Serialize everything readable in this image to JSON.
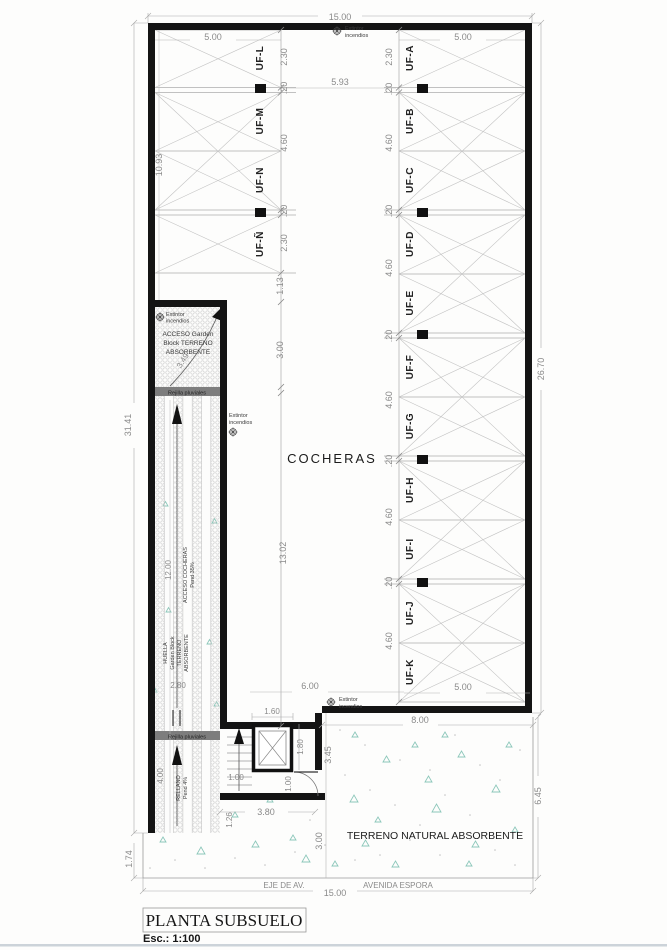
{
  "title_block": {
    "title": "PLANTA SUBSUELO",
    "scale": "Esc.: 1:100"
  },
  "labels": {
    "cocheras": "COCHERAS",
    "terreno": "TERRENO NATURAL ABSORBENTE",
    "eje": "EJE  DE  AV.",
    "avenida": "AVENIDA  ESPORA",
    "rejilla": "Rejilla pluviales",
    "extintor": [
      "Extintor",
      "incendios"
    ],
    "acceso_box": [
      "ACCESO Garden",
      "Block TERRENO",
      "ABSORBENTE"
    ],
    "huella": [
      "HUELLA",
      "Garden Block",
      "TERRENO",
      "ABSORBENTE"
    ],
    "acceso_rampa": [
      "ACCESO COCHERAS",
      "Pend 35%"
    ],
    "rellano": [
      "RELLANO",
      "Pend 4%"
    ]
  },
  "parking": {
    "left": [
      "UF-L",
      "UF-M",
      "UF-N",
      "UF-Ñ"
    ],
    "right": [
      "UF-A",
      "UF-B",
      "UF-C",
      "UF-D",
      "UF-E",
      "UF-F",
      "UF-G",
      "UF-H",
      "UF-I",
      "UF-J",
      "UF-K"
    ]
  },
  "dims": {
    "top_total": "15.00",
    "bottom_total": "15.00",
    "left_total": "31.41",
    "left_bottom": "1.74",
    "left_col": "10.93",
    "right_total": "26.70",
    "right_bottom": "6.45",
    "stall_top_left": "5.00",
    "stall_top_right": "5.00",
    "stall_bottom": "5.00",
    "aisle": "5.93",
    "six": "6.00",
    "eight": "8.00",
    "curve": "3.49",
    "ramp_len": "12.00",
    "ramp_w": "2.80",
    "rellano_len": "4.00",
    "elev_w": "1.60",
    "elev_d": "1.80",
    "stair_w": "1.00",
    "door_w": "1.00",
    "vest_w": "3.80",
    "vest_b": "1.26",
    "patio": "3.45",
    "terr": "3.00",
    "chain_left": [
      "2.30",
      ".20",
      "4.60",
      ".20",
      "2.30",
      "1.13",
      "3.00",
      "13.02"
    ],
    "chain_right": [
      "2.30",
      ".20",
      "4.60",
      ".20",
      "4.60",
      ".20",
      "4.60",
      ".20",
      "4.60",
      ".20",
      "4.60"
    ]
  }
}
